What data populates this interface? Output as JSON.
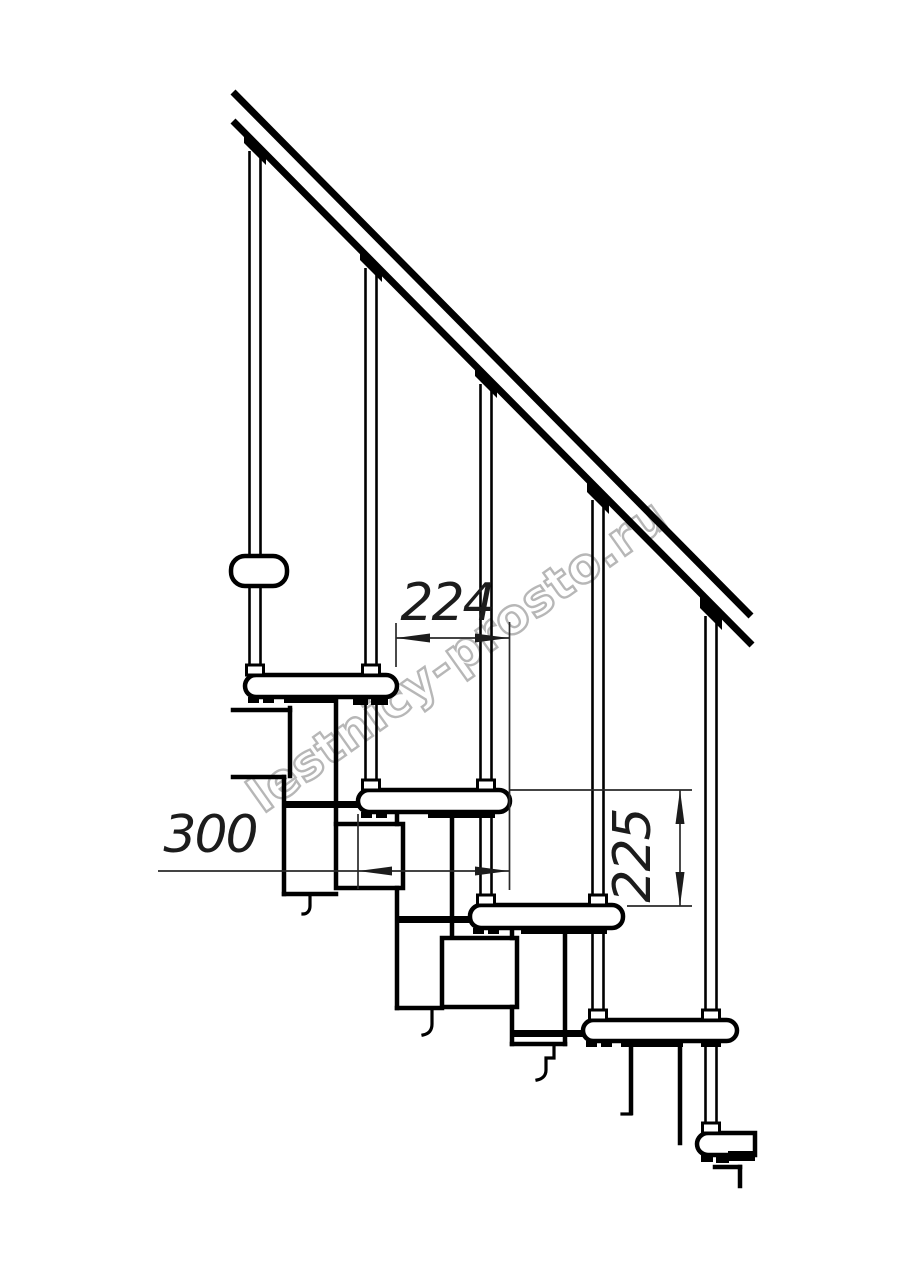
{
  "title": "Modular staircase side-view technical drawing",
  "drawing": {
    "watermark": "lestnicy-prosto.ru",
    "dim_run": "224",
    "dim_depth": "300",
    "dim_rise": "225",
    "colors": {
      "line": "#000000",
      "dimension": "#2a2a2a",
      "watermark": "#b0b0b0",
      "background": "#ffffff"
    }
  }
}
